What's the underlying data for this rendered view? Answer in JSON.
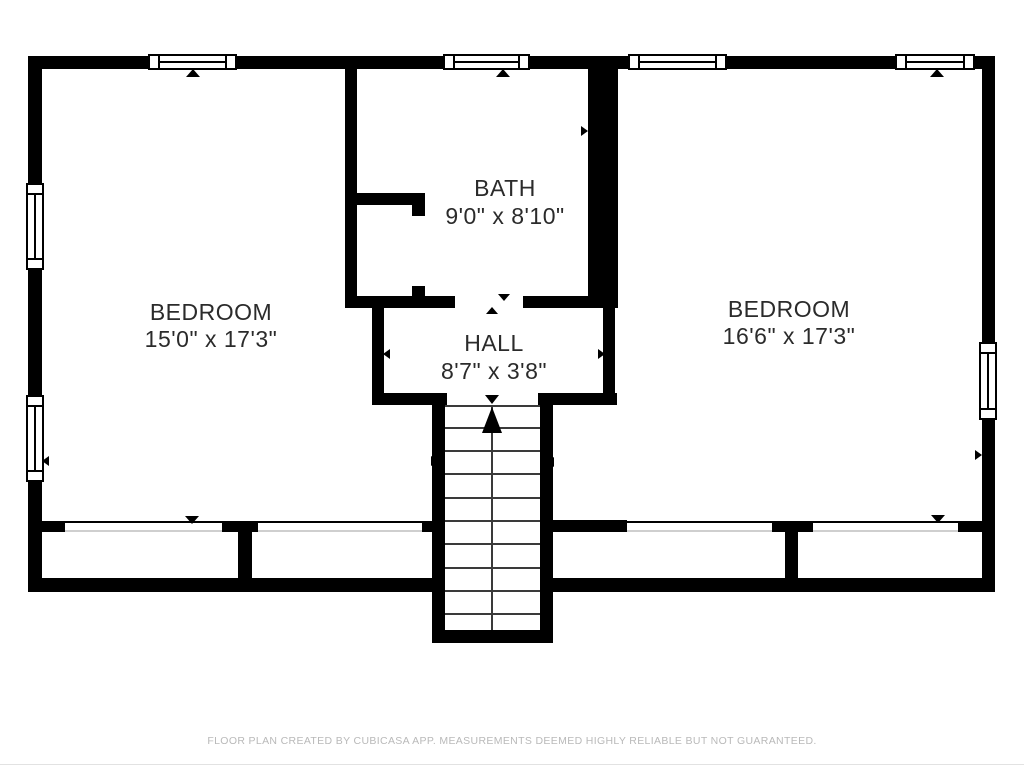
{
  "rooms": [
    {
      "name": "BEDROOM",
      "dimensions": "15'0\" x 17'3\""
    },
    {
      "name": "BATH",
      "dimensions": "9'0\" x 8'10\""
    },
    {
      "name": "HALL",
      "dimensions": "8'7\" x 3'8\""
    },
    {
      "name": "BEDROOM",
      "dimensions": "16'6\" x 17'3\""
    }
  ],
  "meta": {
    "app_credit": "FLOOR PLAN CREATED BY CUBICASA APP. MEASUREMENTS DEEMED HIGHLY RELIABLE BUT NOT GUARANTEED."
  },
  "colors": {
    "background": "#ffffff",
    "wall": "#000000",
    "label": "#2b2b2b",
    "footer": "#b9b9b9",
    "stair_line": "#3a3a3a",
    "closet_track": "#cfcfcf"
  }
}
